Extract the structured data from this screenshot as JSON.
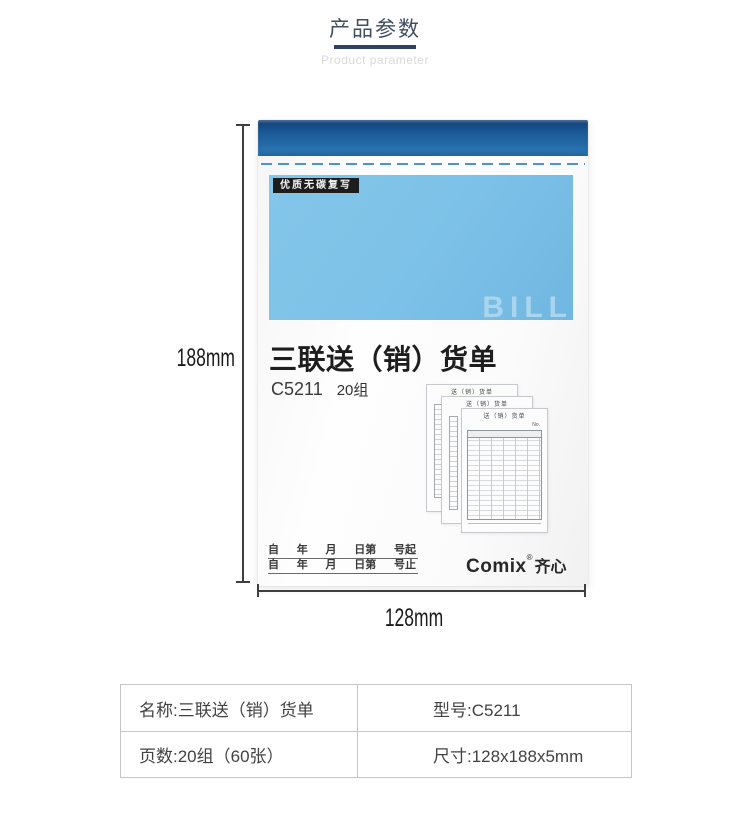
{
  "header": {
    "title": "产品参数",
    "subtitle": "Product parameter",
    "accent_color": "#2d4366"
  },
  "product": {
    "quality_label": "优质无碳复写",
    "watermark": "BILL",
    "title": "三联送（销）货单",
    "model": "C5211",
    "quantity": "20组",
    "mini_form_title": "送（销）货单",
    "mini_form_no": "No.",
    "date_lines": [
      {
        "parts": [
          "自",
          "年",
          "月",
          "日第",
          "号起"
        ]
      },
      {
        "parts": [
          "自",
          "年",
          "月",
          "日第",
          "号止"
        ]
      }
    ],
    "brand": {
      "en": "Comix",
      "reg": "®",
      "cn": "齐心"
    },
    "colors": {
      "binding_blue_top": "#123f74",
      "binding_blue_bottom": "#2e7ab8",
      "cover_panel_blue": "#7cc1e7",
      "watermark_blue": "#aad5ee",
      "label_black": "#1d1d1d"
    }
  },
  "dimensions": {
    "height_label": "188mm",
    "width_label": "128mm"
  },
  "spec_table": {
    "rows": [
      {
        "left": "名称:三联送（销）货单",
        "right": "型号:C5211"
      },
      {
        "left": "页数:20组（60张）",
        "right": "尺寸:128x188x5mm"
      }
    ]
  }
}
